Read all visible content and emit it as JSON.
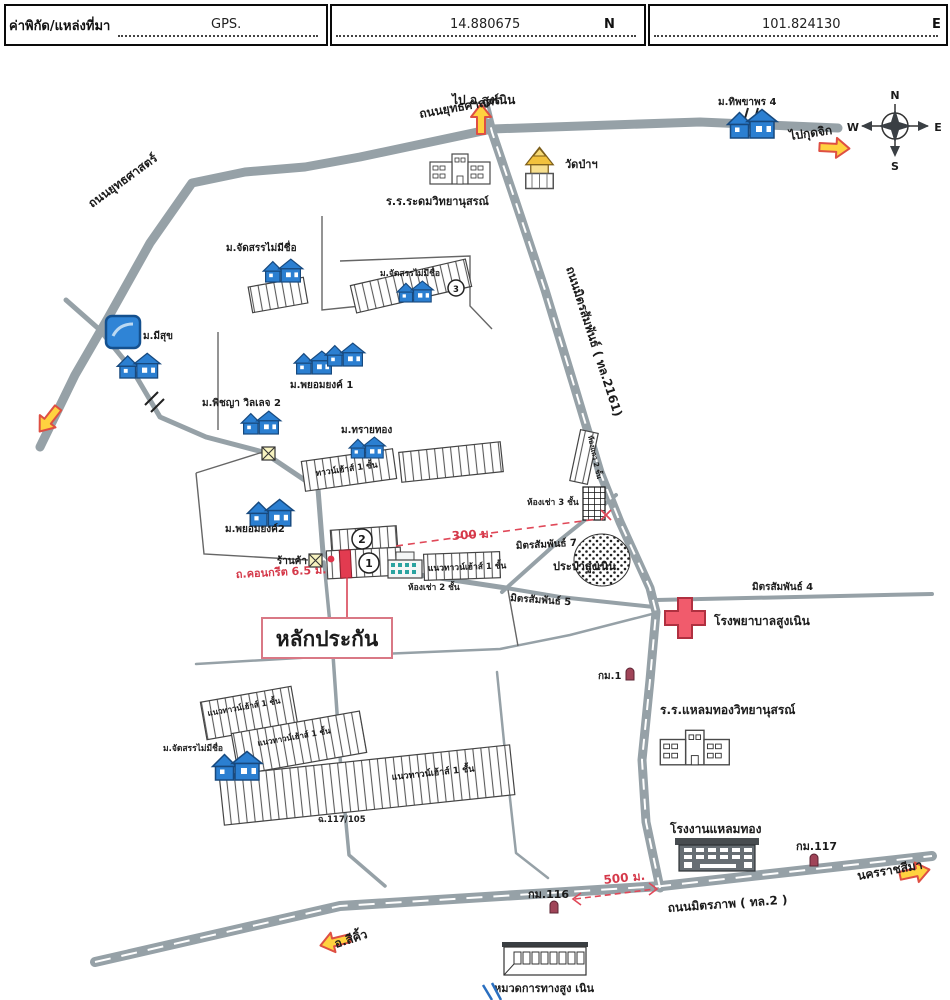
{
  "header": {
    "title": "ค่าพิกัด/แหล่งที่มา",
    "gps": "GPS.",
    "lat": "14.880675",
    "lat_dir": "N",
    "lng": "101.824130",
    "lng_dir": "E"
  },
  "compass": {
    "n": "N",
    "s": "S",
    "e": "E",
    "w": "W"
  },
  "map": {
    "labels": {
      "to_sungnoen": "ไป อ.สูงเนิน",
      "yutthasat": "ถนนยุทธศาสตร์",
      "thipphawan4": "ม.ทิพขาพร 4",
      "to_kutchik": "ไปกุดจิก",
      "wat_pa": "วัดป่าฯ",
      "radom_school": "ร.ร.ระดมวิทยานุสรณ์",
      "mitsamphan_rd": "ถนนมิตรสัมพันธ์ ( ทล.2161)",
      "unnamed_estate": "ม.จัดสรรไม่มีชื่อ",
      "misuk": "ม.มีสุข",
      "phayomyong1": "ม.พยอมยงค์ 1",
      "phichaya2": "ม.พิชญา วิลเลจ 2",
      "saithong": "ม.ทรายทอง",
      "townhouse_1f": "ทาวน์เฮ้าส์ 1 ชั้น",
      "phayomyong2": "ม.พยอมยงค์2",
      "shop": "ร้านค้า",
      "road_width": "ถ.คอนกรีต 6.5 ม.",
      "row_townhouse_1f": "แนวทาวน์เฮ้าส์ 1 ชั้น",
      "rental_2f": "ห้องเช่า 2 ชั้น",
      "rental_3f": "ห้องเช่า 3 ชั้น",
      "rowhouse_2f": "ห้องแถว 2 ชั้น",
      "mitsamphan7": "มิตรสัมพันธ์ 7",
      "mitsamphan5": "มิตรสัมพันธ์ 5",
      "mitsamphan4": "มิตรสัมพันธ์ 4",
      "waterworks": "ประปาสูงเนิน",
      "hospital": "โรงพยาบาลสูงเนิน",
      "collateral": "หลักประกัน",
      "km1": "กม.1",
      "laemthong_school": "ร.ร.แหลมทองวิทยานุสรณ์",
      "laemthong_factory": "โรงงานแหลมทอง",
      "km117": "กม.117",
      "km116": "กม.116",
      "nakhon_ratchasima": "นครราชสีมา",
      "sikhio": "อ.สีคิ้ว",
      "mittraphap_rd": "ถนนมิตรภาพ ( ทล.2 )",
      "highway_office": "หมวดการทางสูง เนิน",
      "deed": "ฉ.117/105",
      "d300": "300 ม.",
      "d500": "500 ม."
    },
    "markers": {
      "m1": "1",
      "m2": "2",
      "m3": "3"
    },
    "colors": {
      "road": "#96a1a7",
      "arrow_fill": "#ffd23f",
      "arrow_stroke": "#de4f43",
      "red_accent": "#d5394a",
      "house_blue": "#2b7fd1",
      "hospital_red": "#f15b6c"
    }
  }
}
